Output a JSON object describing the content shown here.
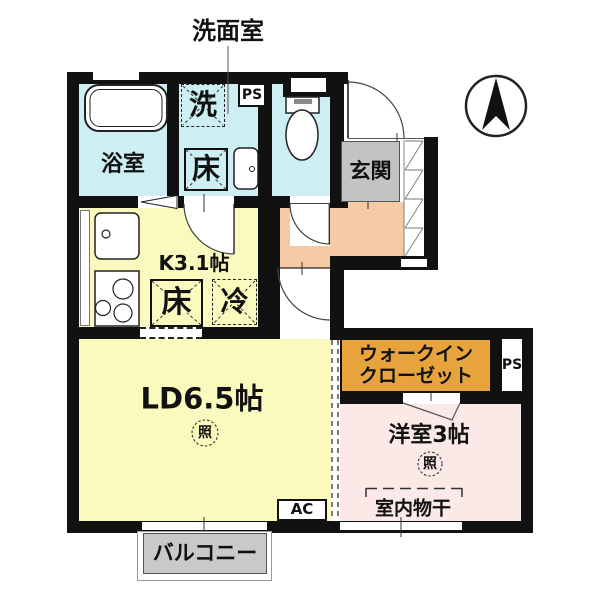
{
  "floorplan": {
    "labels": {
      "washroom_callout": "洗面室",
      "bath": "浴室",
      "washer": "洗",
      "floor": "床",
      "ps": "PS",
      "kitchen": "K3.1帖",
      "fridge": "冷",
      "living": "LD6.5帖",
      "light": "照",
      "entrance": "玄関",
      "wic_line1": "ウォークイン",
      "wic_line2": "クローゼット",
      "western": "洋室3帖",
      "drying": "室内物干",
      "ac": "AC",
      "balcony": "バルコニー"
    },
    "colors": {
      "wall": "#111111",
      "wet_rooms_cyan": "#cdeef2",
      "kitchen_living_yellow": "#fafabe",
      "hallway_peach": "#f4cba4",
      "western_room_pink": "#fae9e6",
      "wic_orange": "#e8a43c",
      "entrance_mat_gray": "#c3c3c3",
      "balcony_gray": "#c9c9c9"
    },
    "icons": [
      "compass-north-icon",
      "bathtub-icon",
      "toilet-icon",
      "wash-basin-icon",
      "kitchen-sink-icon",
      "stove-icon",
      "door-swing-icon",
      "folding-door-icon",
      "entrance-step-hatch-icon",
      "clothes-rail-icon",
      "ceiling-light-icon"
    ]
  }
}
